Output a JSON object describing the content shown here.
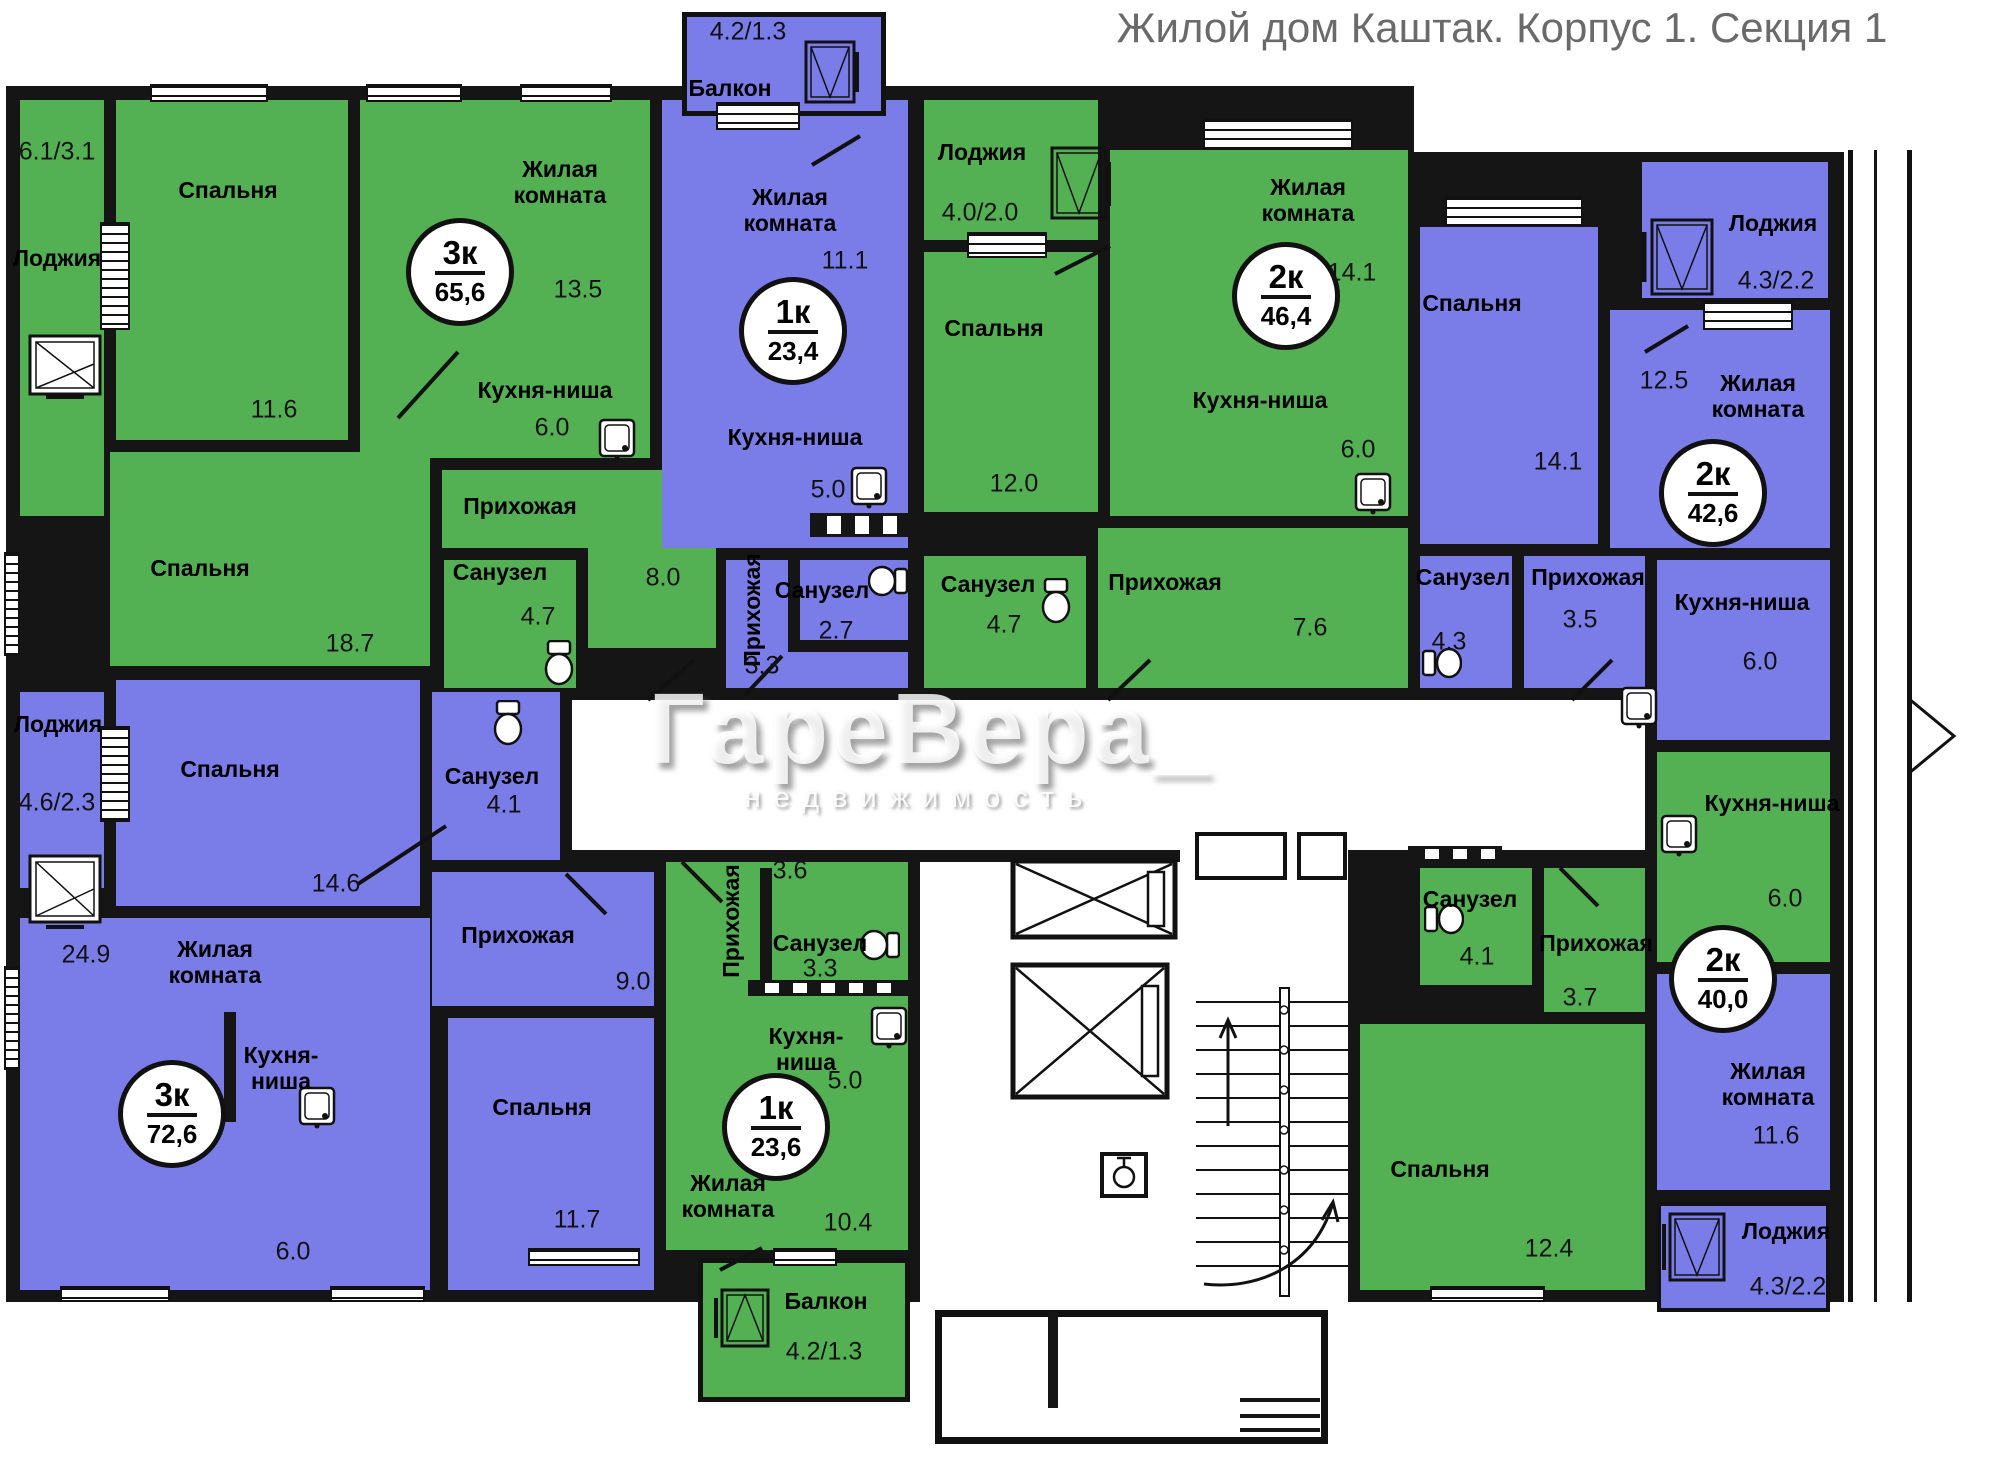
{
  "title": "Жилой дом Каштак. Корпус 1. Секция 1",
  "watermark": {
    "brand": "ГареВера_",
    "subtitle": "недвижимость"
  },
  "colors": {
    "green_flat": "#53b153",
    "purple_flat": "#7a7ce8",
    "wall": "#151515",
    "title_gray": "#6a6a6a"
  },
  "apartments": [
    {
      "name": "3к 65,6",
      "badge_rooms": "3к",
      "badge_area": "65,6",
      "rooms": [
        {
          "label": "Лоджия",
          "area": "6.1/3.1"
        },
        {
          "label": "Спальня",
          "area": "11.6"
        },
        {
          "label": "Жилая\nкомната",
          "area": "13.5"
        },
        {
          "label": "Кухня-ниша",
          "area": "6.0"
        },
        {
          "label": "Прихожая",
          "area": "8.0"
        },
        {
          "label": "Спальня",
          "area": "18.7"
        },
        {
          "label": "Санузел",
          "area": "4.7"
        }
      ]
    },
    {
      "name": "1к 23,4",
      "badge_rooms": "1к",
      "badge_area": "23,4",
      "rooms": [
        {
          "label": "Балкон",
          "area": "4.2/1.3"
        },
        {
          "label": "Жилая\nкомната",
          "area": "11.1"
        },
        {
          "label": "Кухня-ниша",
          "area": "5.0"
        },
        {
          "label": "Прихожая",
          "area": "3.3"
        },
        {
          "label": "Санузел",
          "area": "2.7"
        }
      ]
    },
    {
      "name": "2к 46,4",
      "badge_rooms": "2к",
      "badge_area": "46,4",
      "rooms": [
        {
          "label": "Лоджия",
          "area": "4.0/2.0"
        },
        {
          "label": "Спальня",
          "area": "12.0"
        },
        {
          "label": "Жилая\nкомната",
          "area": "14.1"
        },
        {
          "label": "Кухня-ниша",
          "area": "6.0"
        },
        {
          "label": "Санузел",
          "area": "4.7"
        },
        {
          "label": "Прихожая",
          "area": "7.6"
        }
      ]
    },
    {
      "name": "2к 42,6",
      "badge_rooms": "2к",
      "badge_area": "42,6",
      "rooms": [
        {
          "label": "Спальня",
          "area": "14.1"
        },
        {
          "label": "Лоджия",
          "area": "4.3/2.2"
        },
        {
          "label": "Жилая\nкомната",
          "area": "12.5"
        },
        {
          "label": "Кухня-ниша",
          "area": "6.0"
        },
        {
          "label": "Санузел",
          "area": "4.3"
        },
        {
          "label": "Прихожая",
          "area": "3.5"
        }
      ]
    },
    {
      "name": "3к 72,6",
      "badge_rooms": "3к",
      "badge_area": "72,6",
      "rooms": [
        {
          "label": "Лоджия",
          "area": "4.6/2.3"
        },
        {
          "label": "Спальня",
          "area": "14.6"
        },
        {
          "label": "Санузел",
          "area": "4.1"
        },
        {
          "label": "Прихожая",
          "area": "9.0"
        },
        {
          "label": "Жилая\nкомната",
          "area": "24.9"
        },
        {
          "label": "Кухня-\nниша",
          "area": "6.0"
        },
        {
          "label": "Спальня",
          "area": "11.7"
        }
      ]
    },
    {
      "name": "1к 23,6",
      "badge_rooms": "1к",
      "badge_area": "23,6",
      "rooms": [
        {
          "label": "Прихожая",
          "area": "3.6"
        },
        {
          "label": "Санузел",
          "area": "3.3"
        },
        {
          "label": "Кухня-\nниша",
          "area": "5.0"
        },
        {
          "label": "Жилая\nкомната",
          "area": "10.4"
        },
        {
          "label": "Балкон",
          "area": "4.2/1.3"
        }
      ]
    },
    {
      "name": "2к 40,0",
      "badge_rooms": "2к",
      "badge_area": "40,0",
      "rooms": [
        {
          "label": "Санузел",
          "area": "4.1"
        },
        {
          "label": "Прихожая",
          "area": "3.7"
        },
        {
          "label": "Кухня-ниша",
          "area": "6.0"
        },
        {
          "label": "Жилая\nкомната",
          "area": "11.6"
        },
        {
          "label": "Спальня",
          "area": "12.4"
        },
        {
          "label": "Лоджия",
          "area": "4.3/2.2"
        }
      ]
    }
  ]
}
